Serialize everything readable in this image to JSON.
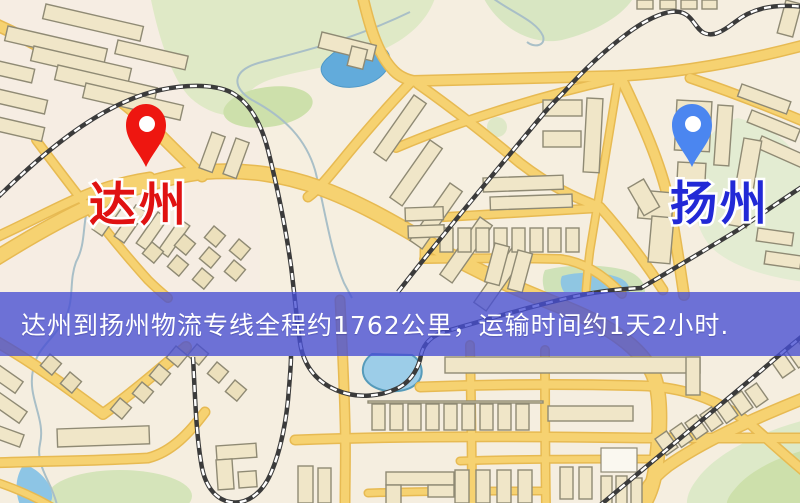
{
  "map": {
    "origin": {
      "label": "达州",
      "pin_icon": "red-location-pin-icon",
      "pin_color": "#ee1610",
      "label_color": "#e01212"
    },
    "destination": {
      "label": "扬州",
      "pin_icon": "blue-location-pin-icon",
      "pin_color": "#4b86f0",
      "label_color": "#2229d6"
    }
  },
  "banner": {
    "text": "达州到扬州物流专线全程约1762公里，运输时间约1天2小时.",
    "background_color": "#474ed3",
    "text_color": "#ffffff"
  },
  "theme": {
    "background": "#f5eee0",
    "road": "#f6d271",
    "road_casing": "#e7ba52",
    "building": "#f0e6c8",
    "railway": "#3b3b3b",
    "park_green": "#dfe9c6",
    "lake_blue": "#62abdb"
  }
}
